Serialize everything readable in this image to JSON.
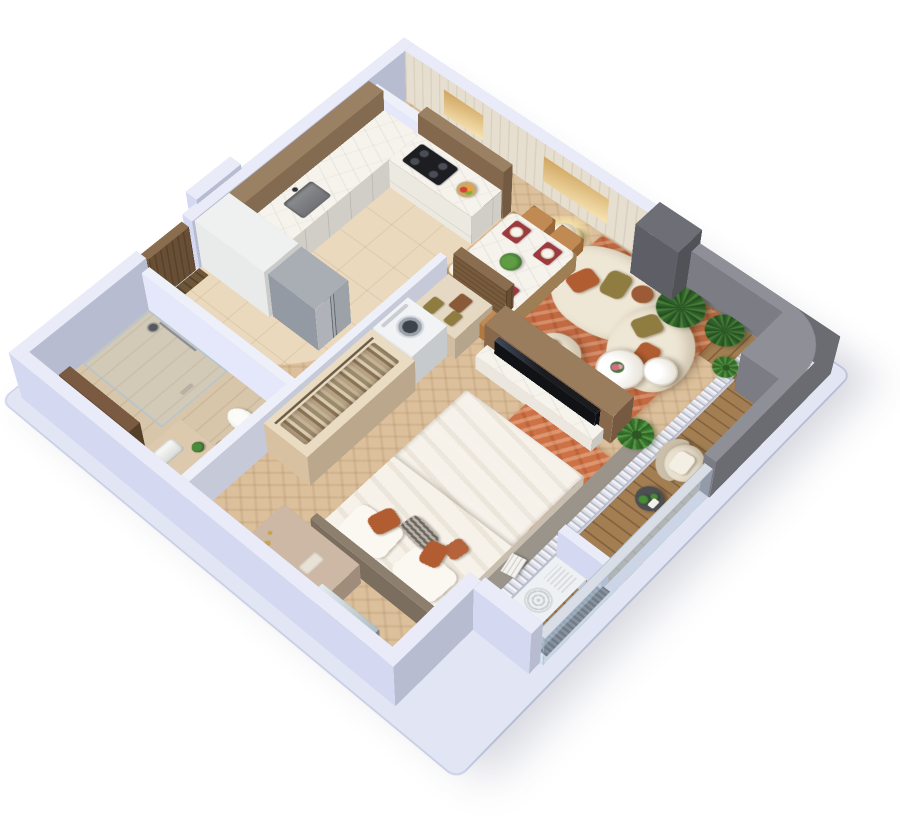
{
  "title": "isometric-3d-apartment-floor-plan",
  "palette": {
    "background": "#ffffff",
    "wall_top": "#e9ecf8",
    "wall_side": "#ccd1e8",
    "parapet": "#8f8f97",
    "parapet_dark": "#6e6e76",
    "floor_wood": "#dcc09c",
    "floor_tile": "#ead9bd",
    "floor_stone": "#d8c6ab",
    "deck_wood": "#a37e52",
    "rug_living": "#c26a42",
    "rug_bedroom": "#cd7247",
    "sofa": "#efe7d5",
    "pillow_rust": "#b25c31",
    "pillow_olive": "#8f7c40",
    "cabinet_brown": "#9b8164",
    "cabinet_white": "#eff1f0",
    "marble": "#f6f3ed",
    "stainless": "#a9aeb5",
    "wood_door": "#8a6d4e",
    "tv": "#1b1c20",
    "chair_tan": "#c08a52",
    "placemat_red": "#9c3a40",
    "plant_green": "#3f6f33",
    "bed_white": "#f6f2ea",
    "throw_taupe": "#a3937e",
    "curtain_gray": "#b4b8c6",
    "glass": "#c3d7e8",
    "washer_white": "#f2f3f5",
    "ac_white": "#eef1f3"
  },
  "scene": {
    "view": "isometric cutaway apartment render, no visible text labels",
    "rooms": [
      {
        "name": "entry-hall",
        "items": [
          "entry-door",
          "tall-white-cabinet",
          "vent-shaft",
          "door-mat"
        ]
      },
      {
        "name": "kitchen",
        "items": [
          "refrigerator",
          "upper-cabinets",
          "glass-display-cabinet",
          "marble-counter-l-shape",
          "sink",
          "faucet",
          "cooktop",
          "oven",
          "fruit-bowl",
          "curved-tile-floor"
        ]
      },
      {
        "name": "bathroom",
        "items": [
          "walk-in-glass-shower",
          "shower-head",
          "vanity-sink",
          "toilet",
          "tall-mirror-cabinet",
          "stool",
          "small-plant"
        ]
      },
      {
        "name": "wardrobe-laundry",
        "items": [
          "open-closet-hanging-clothes",
          "washing-machine",
          "shelf-with-folded-towels",
          "sliding-wood-door",
          "half-wall-plant"
        ]
      },
      {
        "name": "dining-area",
        "items": [
          "marble-dining-table",
          "four-tan-chairs",
          "four-red-placemats",
          "plates",
          "centerpiece-plant"
        ]
      },
      {
        "name": "living-room",
        "items": [
          "curved-cream-sofa",
          "rust-and-olive-pillows",
          "two-round-coffee-tables",
          "flower-vase",
          "armchair",
          "floor-lamp",
          "terracotta-rug",
          "tv-partition",
          "tv-screen",
          "marble-console",
          "two-gold-wall-artworks",
          "floor-plant"
        ]
      },
      {
        "name": "bedroom",
        "items": [
          "double-bed",
          "headboard",
          "white-duvet",
          "taupe-throw",
          "rust-pillows",
          "striped-pillow",
          "orange-area-rug",
          "vanity-desk",
          "leaning-mirror",
          "pouf-stool",
          "books-stack",
          "gray-threshold"
        ]
      },
      {
        "name": "balcony",
        "items": [
          "wood-decking",
          "glass-railing",
          "curved-gray-parapet",
          "corner-shaft-column",
          "lounge-chair",
          "side-table",
          "two-palm-plants",
          "potted-plant",
          "ac-condenser-unit",
          "louver-screen",
          "slat-curtain-band"
        ]
      }
    ]
  }
}
